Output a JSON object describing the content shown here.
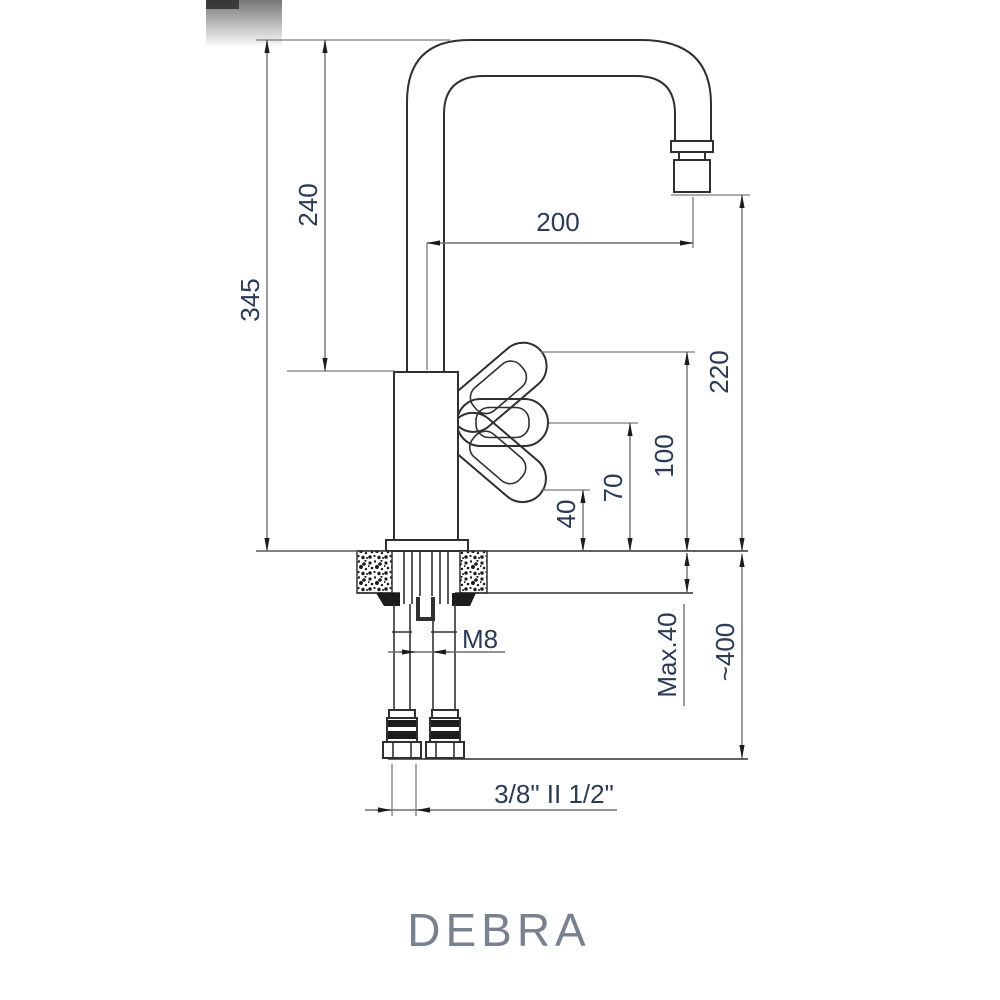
{
  "page": {
    "background": "#ffffff"
  },
  "title": {
    "model_name": "DEBRA",
    "color": "#79818f"
  },
  "drawing": {
    "type": "technical-dimension-drawing",
    "subject": "single-lever kitchen mixer tap, side view with deck-mount cross-section",
    "line_color": "#303030",
    "dimension_text_color": "#2b3a55",
    "labels": {
      "total_height": "345",
      "height_to_body_top": "240",
      "spout_reach": "200",
      "spout_outlet_height": "220",
      "lever_up_height": "100",
      "lever_mid_height": "70",
      "lever_down_height": "40",
      "max_deck_thickness": "Max.40",
      "hose_drop_length": "~400",
      "fixing_stud_thread": "M8",
      "hose_connection_size": "3/8\" II 1/2\""
    }
  }
}
